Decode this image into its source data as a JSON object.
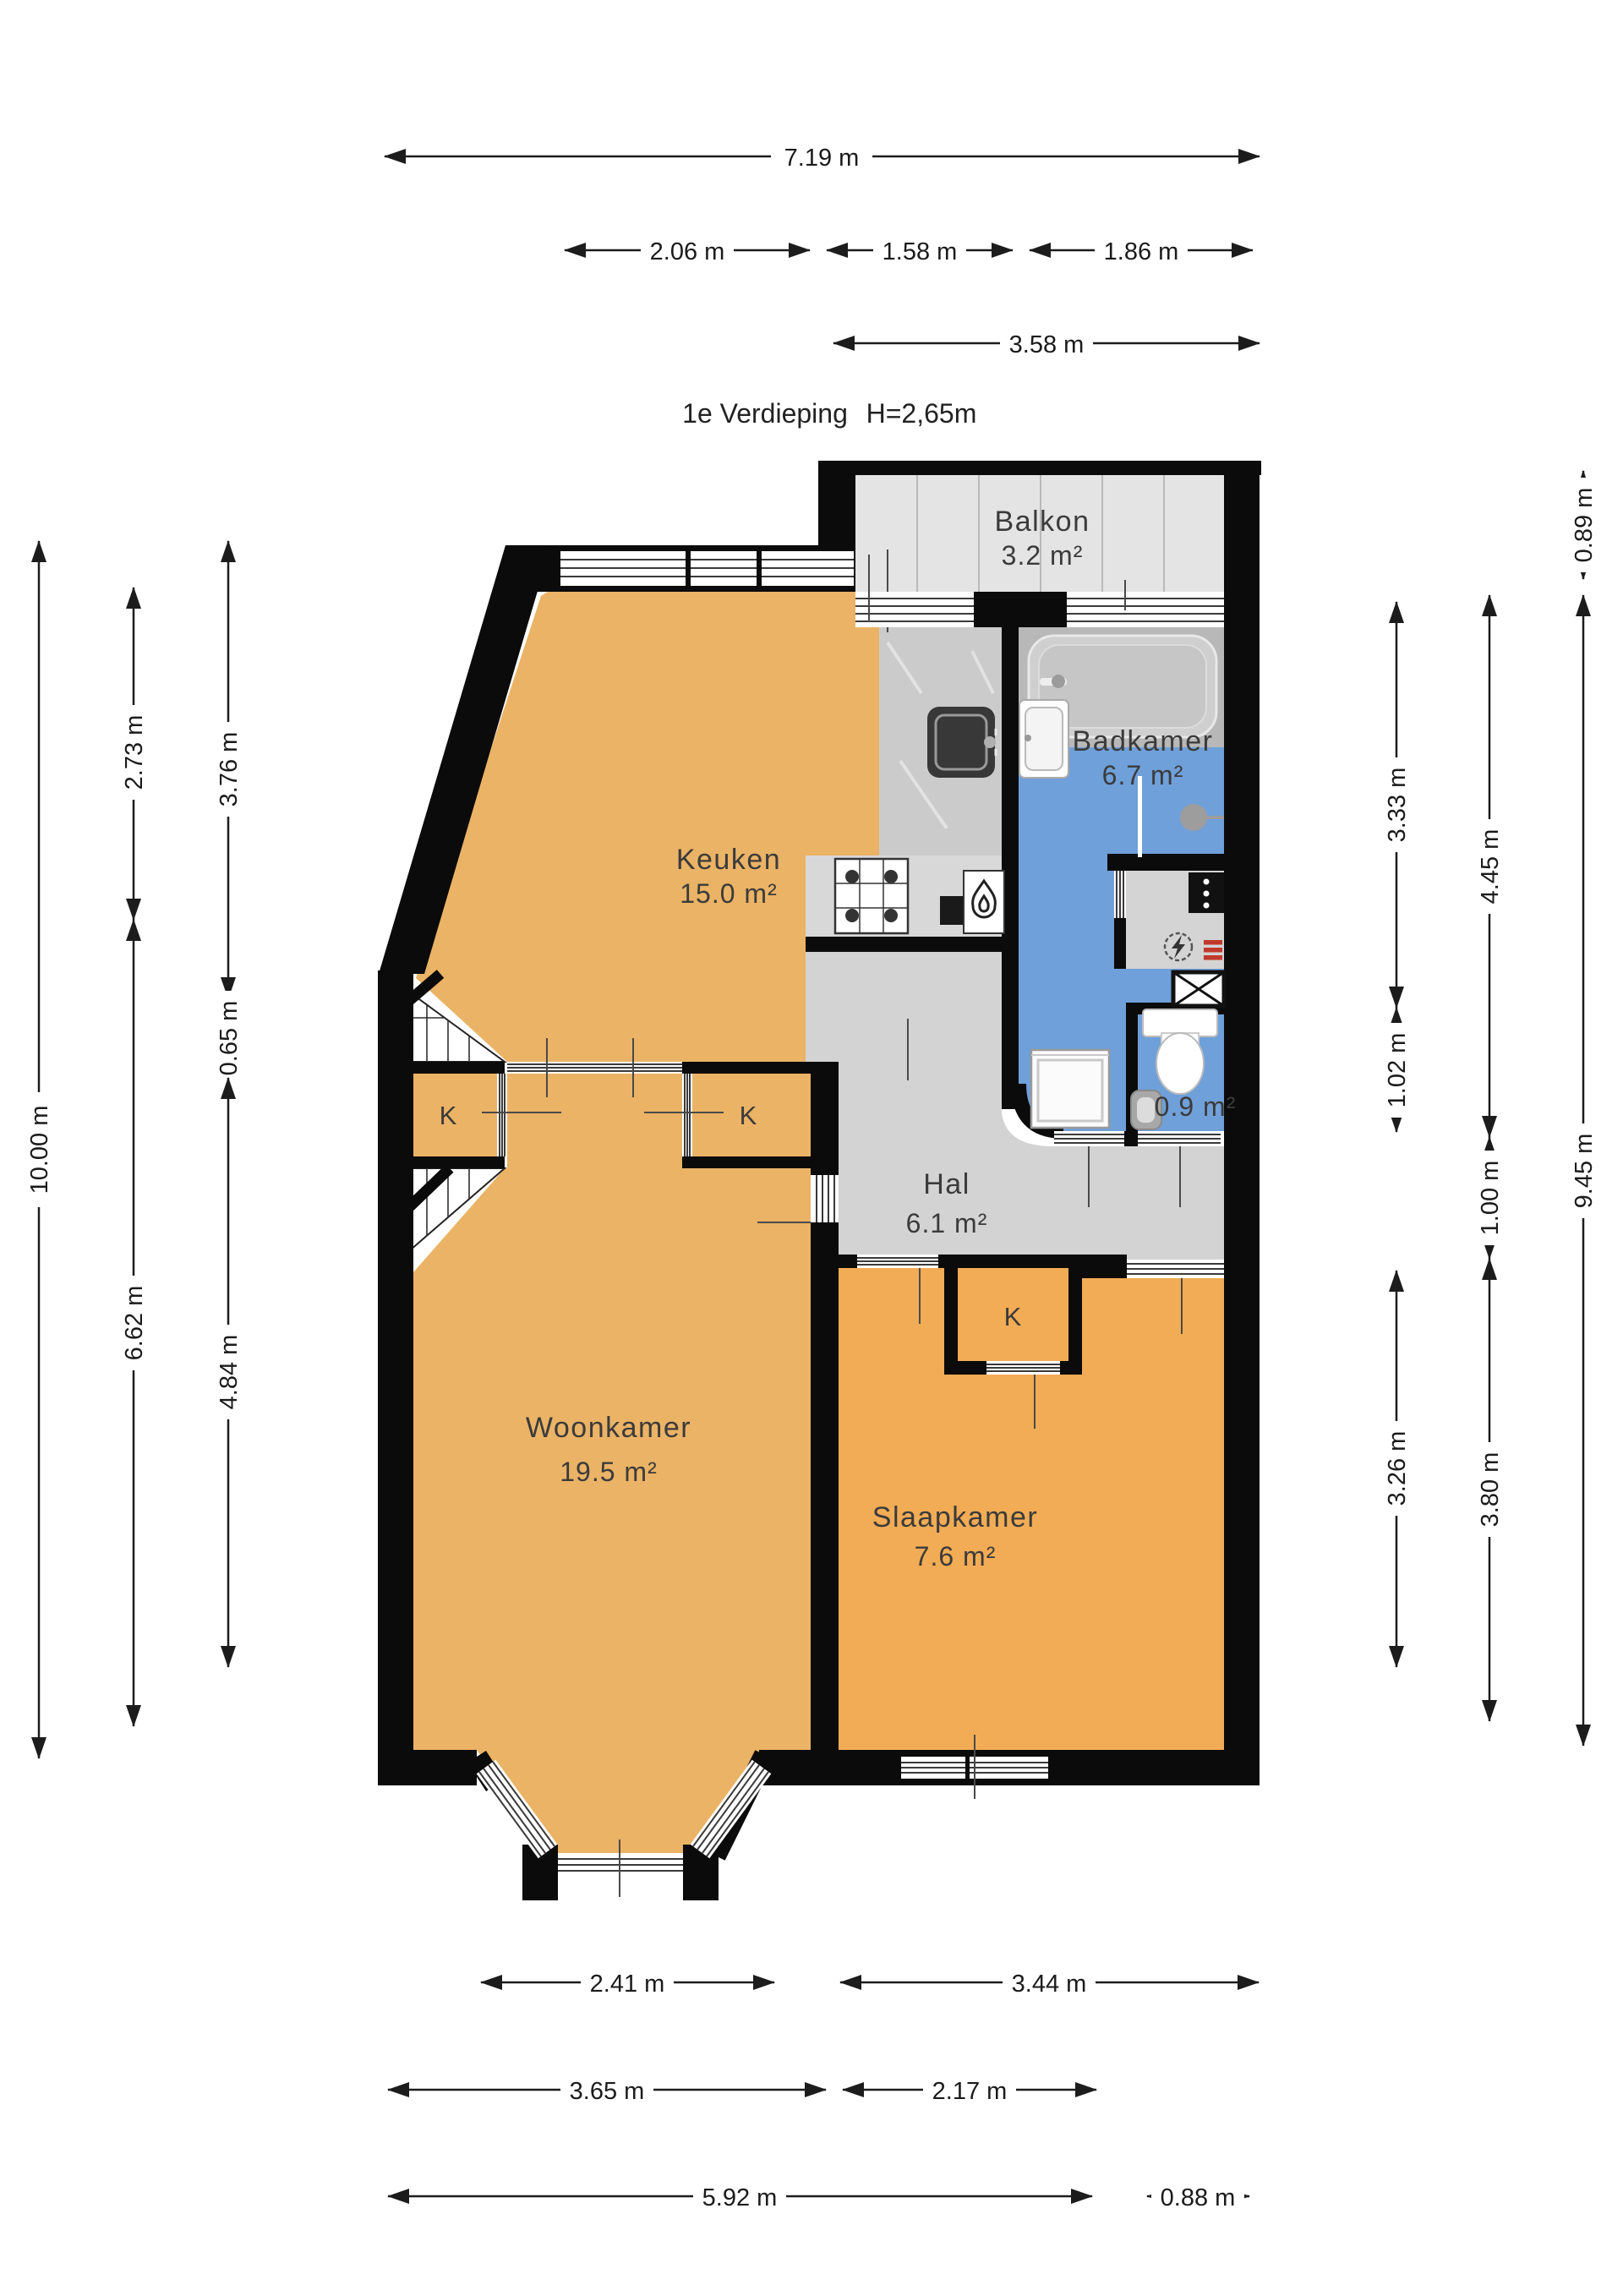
{
  "title": {
    "floor": "1e Verdieping",
    "height": "H=2,65m"
  },
  "rooms": {
    "balkon": {
      "name": "Balkon",
      "area": "3.2 m²"
    },
    "keuken": {
      "name": "Keuken",
      "area": "15.0 m²"
    },
    "badkamer": {
      "name": "Badkamer",
      "area": "6.7 m²"
    },
    "toilet": {
      "area": "0.9 m²"
    },
    "hal": {
      "name": "Hal",
      "area": "6.1 m²"
    },
    "woonkamer": {
      "name": "Woonkamer",
      "area": "19.5 m²"
    },
    "slaapkamer": {
      "name": "Slaapkamer",
      "area": "7.6 m²"
    },
    "closet_label": "K"
  },
  "dimensions": {
    "top": {
      "total": "7.19 m",
      "sub1": "2.06 m",
      "sub2": "1.58 m",
      "sub3": "1.86 m",
      "balcony": "3.58 m"
    },
    "left": {
      "total": "10.00 m",
      "upper": "2.73 m",
      "lower": "6.62 m",
      "col2_upper": "3.76 m",
      "col2_mid": "0.65 m",
      "col2_lower": "4.84 m"
    },
    "right": {
      "balcony": "0.89 m",
      "total": "9.45 m",
      "bath": "3.33 m",
      "toilet": "1.02 m",
      "bedroom_inner": "3.26 m",
      "bath_total": "4.45 m",
      "hall": "1.00 m",
      "bedroom": "3.80 m"
    },
    "bottom": {
      "bay": "2.41 m",
      "bedroom": "3.44 m",
      "living": "3.65 m",
      "hall_part": "2.17 m",
      "total": "5.92 m",
      "entry": "0.88 m"
    }
  },
  "icons": {
    "boiler": "flame-icon",
    "meter": "electricity-meter-icon",
    "shaft": "shaft-cross-icon",
    "radiator": "radiator-icon"
  },
  "colors": {
    "wall": "#0b0b0b",
    "living_orange": "#EBB366",
    "bedroom_orange": "#F2AC55",
    "bath_blue": "#6FA0D9",
    "hall_grey": "#D3D3D3",
    "balcony_grey": "#E4E4E4"
  }
}
